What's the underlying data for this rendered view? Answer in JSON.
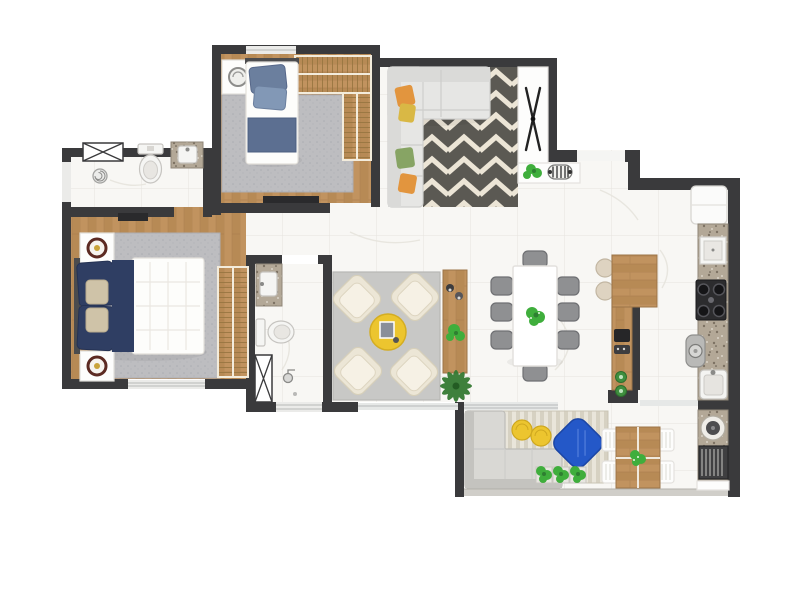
{
  "palette": {
    "wall": "#3a3a3c",
    "floor_tile": "#f8f7f4",
    "wood": "#c1935f",
    "granite": "#b3a897",
    "chevron_dark": "#5b5953",
    "chevron_light": "#ece5d6",
    "balcony_stripe_a": "#e9e5da",
    "balcony_stripe_b": "#d6d1c2",
    "rug_gray": "#bdbdc0",
    "rug_living": "#c8c8c6",
    "sofa_light": "#e6e6e4",
    "armchair_cream": "#ece6d6",
    "accent_yellow": "#ecc52f",
    "accent_blue": "#2458c8",
    "navy": "#2f3e63",
    "denim": "#6b7f9e",
    "dining_chair": "#8f9092",
    "plant_green": "#3fae3c",
    "outdoor_sofa": "#d9d8d4",
    "grill_dark": "#3f3f41",
    "white": "#ffffff"
  },
  "rooms": [
    {
      "name": "ensuite-bathroom",
      "furniture": [
        "window-box",
        "side-window",
        "shower-drain",
        "toilet",
        "granite-vanity-sink"
      ]
    },
    {
      "name": "bedroom-2",
      "furniture": [
        "single-bed",
        "nightstand",
        "l-wardrobe",
        "gray-rug",
        "tv-console",
        "window"
      ]
    },
    {
      "name": "tv-lounge",
      "furniture": [
        "corner-sofa",
        "chevron-rug",
        "entry-console",
        "x-decor",
        "plant",
        "striped-decor"
      ]
    },
    {
      "name": "master-bedroom",
      "furniture": [
        "double-bed",
        "nightstand-top",
        "nightstand-bottom",
        "slatted-wardrobe",
        "gray-rug",
        "tv-console",
        "window"
      ]
    },
    {
      "name": "bathroom-2",
      "furniture": [
        "granite-vanity-sink",
        "toilet",
        "shower-box",
        "window"
      ]
    },
    {
      "name": "living-room",
      "furniture": [
        "gray-rug",
        "armchair-1",
        "armchair-2",
        "armchair-3",
        "armchair-4",
        "round-coffee-table",
        "wood-console",
        "palm-plant"
      ]
    },
    {
      "name": "dining-room",
      "furniture": [
        "dining-table",
        "eight-chairs",
        "centerpiece-plant"
      ]
    },
    {
      "name": "kitchen",
      "furniture": [
        "breakfast-bar",
        "two-stools",
        "fridge",
        "microwave",
        "stove",
        "washer",
        "sink",
        "granite-counter"
      ]
    },
    {
      "name": "balcony",
      "furniture": [
        "striped-rug",
        "outdoor-corner-sofa",
        "yellow-poufs",
        "blue-beanbag",
        "three-planters",
        "outdoor-table",
        "four-chairs",
        "bbq-counter",
        "grill",
        "glass-railing"
      ]
    }
  ]
}
